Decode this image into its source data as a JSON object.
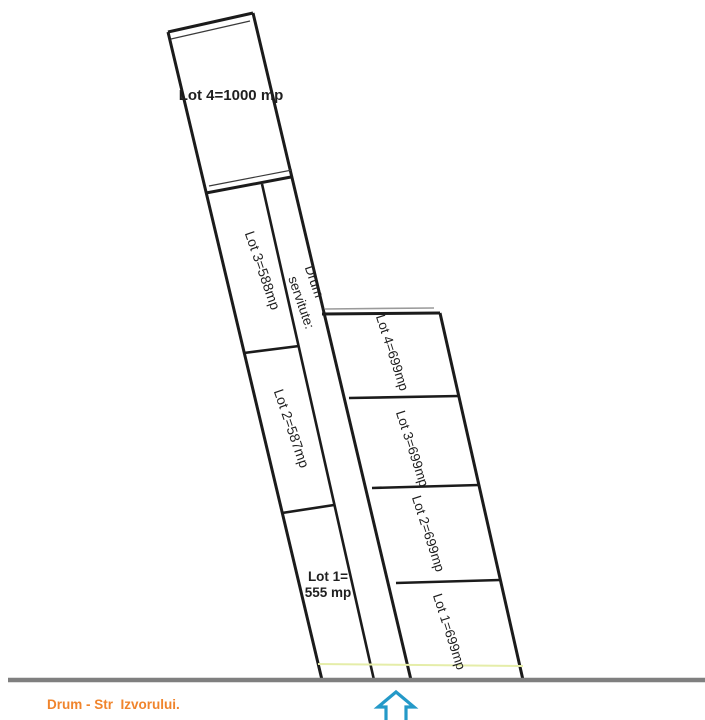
{
  "colors": {
    "line_black": "#1b1b1b",
    "road_line": "#7f7f7f",
    "boundary_yellow": "#e5eda9",
    "road_text": "#f0842c",
    "arrow_blue": "#2499c8"
  },
  "left_strip": {
    "lot4_label": "Lot 4=1000 mp",
    "lot3_label": "Lot 3=588mp",
    "drum_line1": "Drum",
    "drum_line2": "servitute:",
    "lot2_label": "Lot 2=587mp",
    "lot1_line1": "Lot 1=",
    "lot1_line2": "555 mp"
  },
  "right_strip": {
    "lot4_label": "Lot 4=699mp",
    "lot3_label": "Lot 3=699mp",
    "lot2_label": "Lot 2=699mp",
    "lot1_label": "Lot 1=699mp"
  },
  "road_label": "Drum - Str  Izvorului."
}
